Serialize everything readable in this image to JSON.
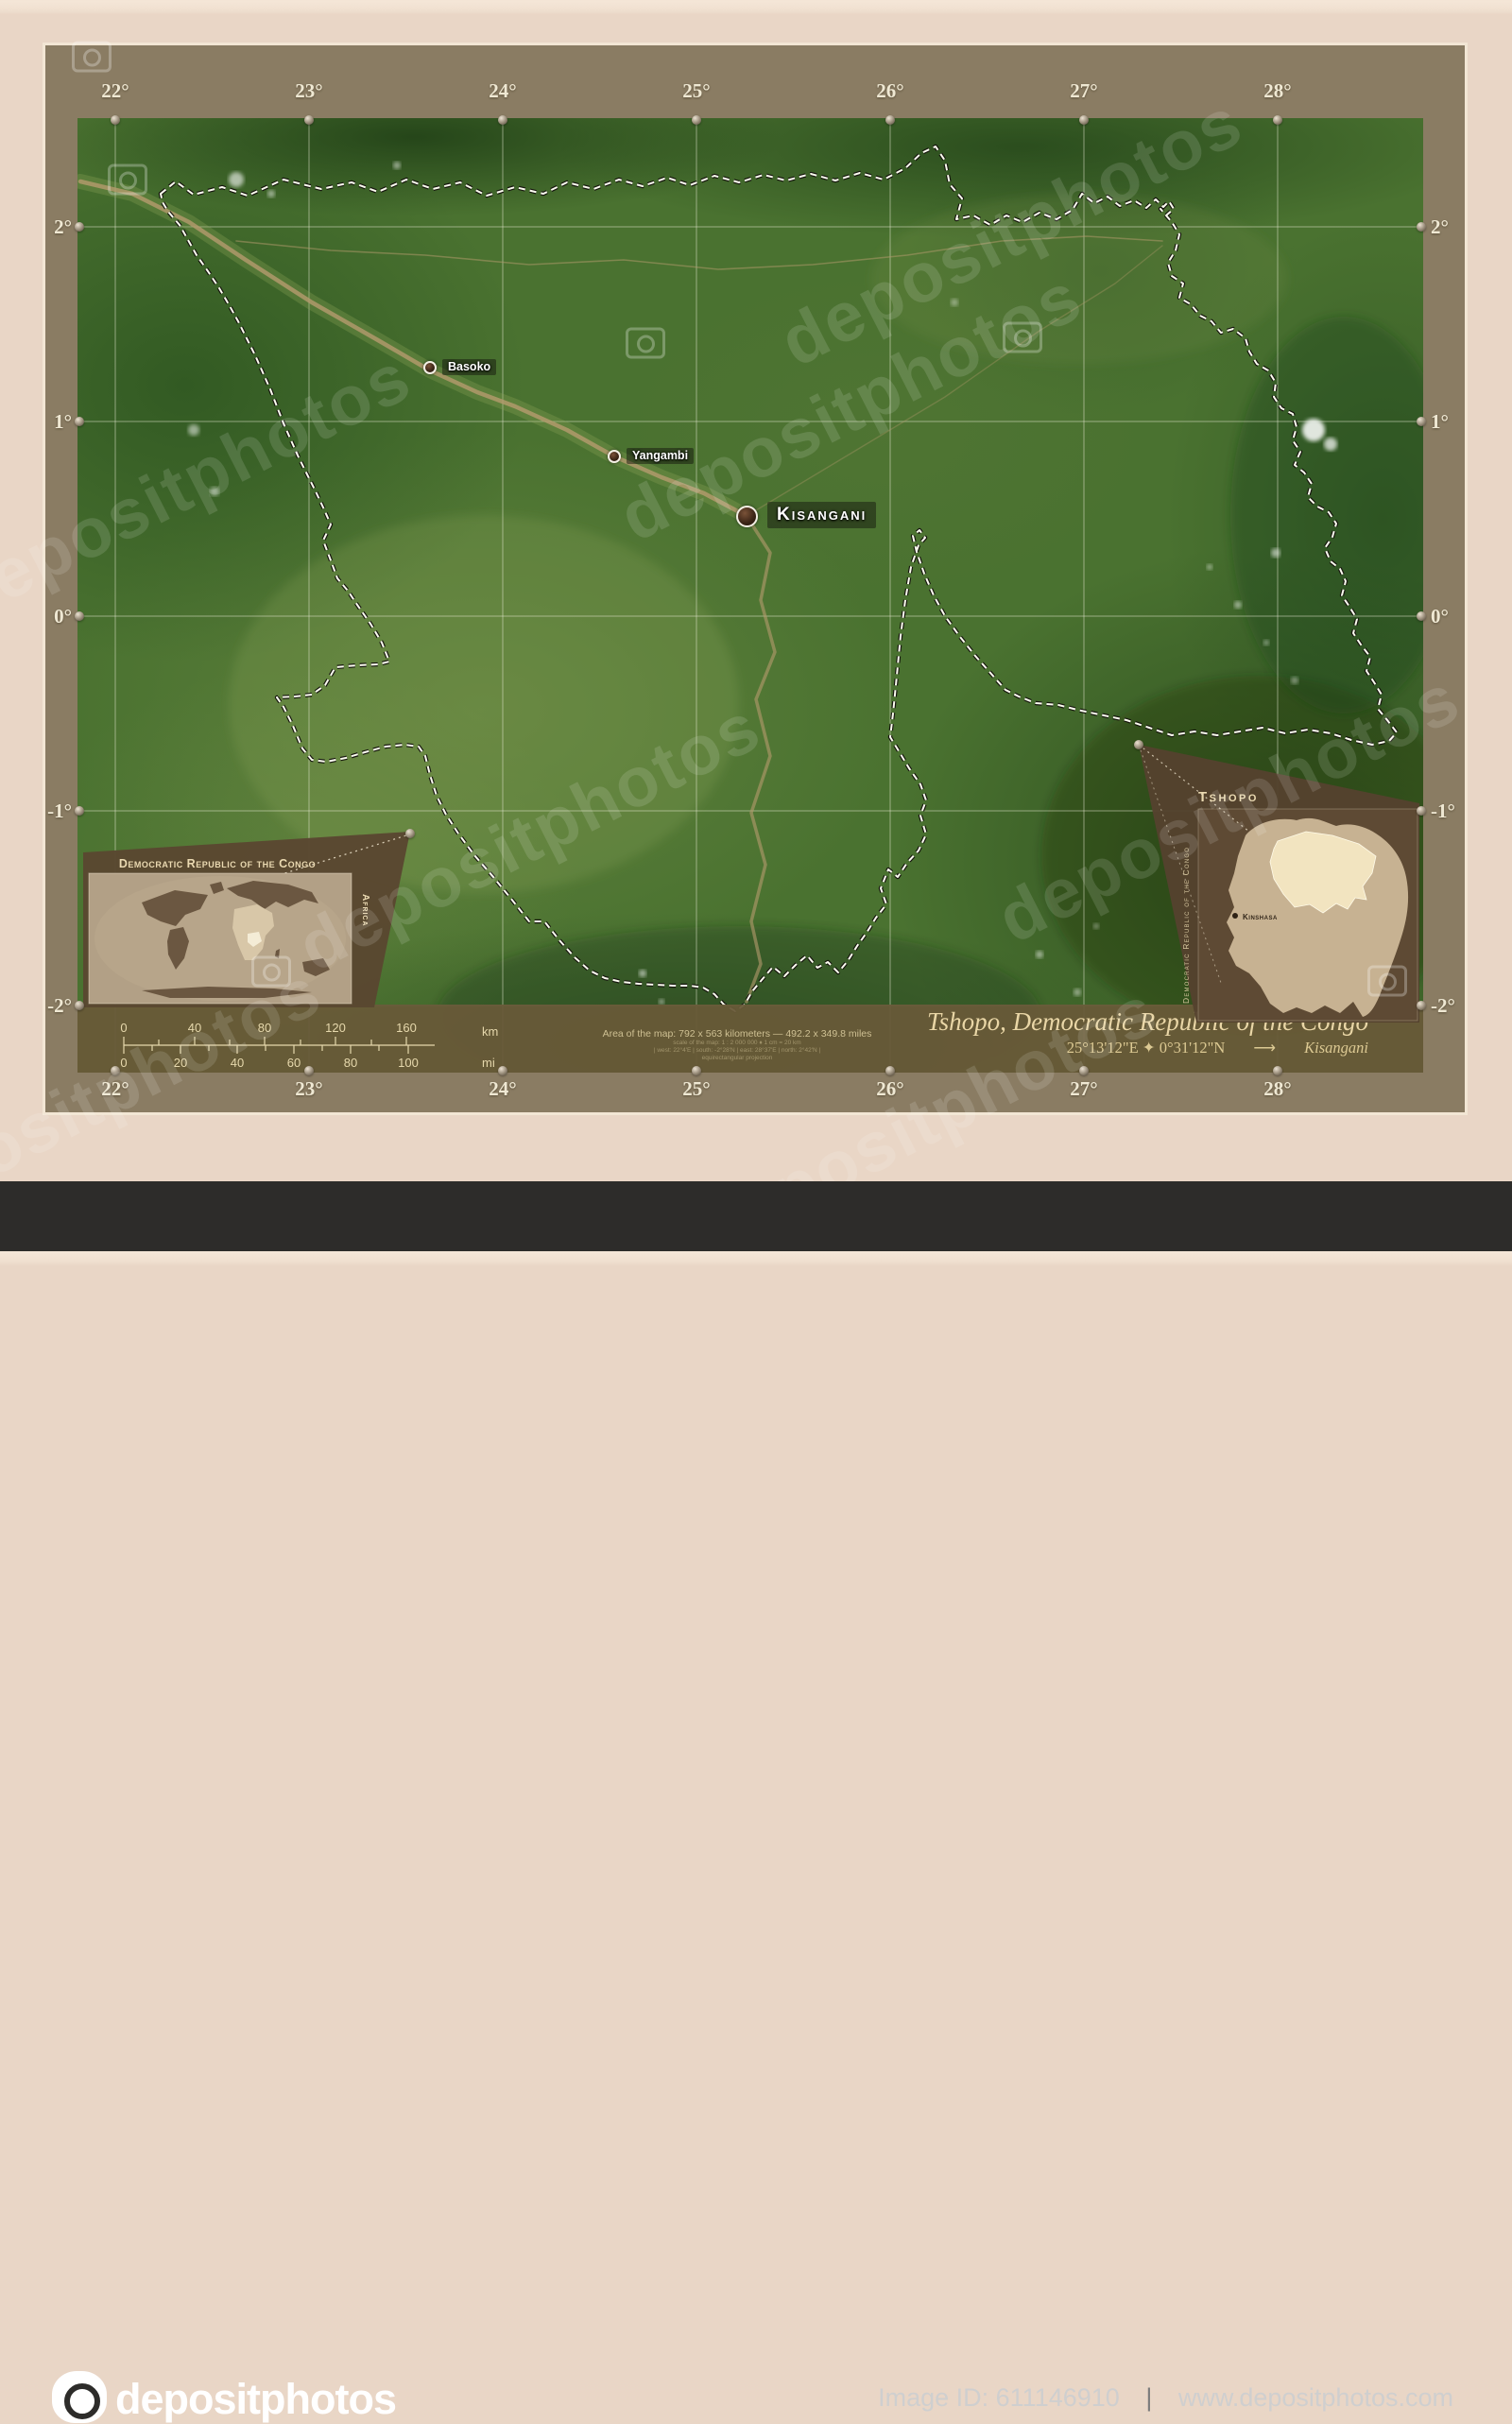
{
  "axes": {
    "lon": [
      "22°",
      "23°",
      "24°",
      "25°",
      "26°",
      "27°",
      "28°"
    ],
    "lat": [
      "2°",
      "1°",
      "0°",
      "-1°",
      "-2°"
    ]
  },
  "cities": {
    "kisangani": "Kisangani",
    "basoko": "Basoko",
    "yangambi": "Yangambi"
  },
  "insets": {
    "world": {
      "title": "Democratic Republic of the Congo",
      "region_label": "Africa"
    },
    "country": {
      "title": "Tshopo",
      "vertical_label": "Democratic Republic of the Congo",
      "capital": "Kinshasa"
    }
  },
  "scale_bar": {
    "km_ticks": [
      "0",
      "40",
      "80",
      "120",
      "160"
    ],
    "km_unit": "km",
    "mi_ticks": [
      "0",
      "20",
      "40",
      "60",
      "80",
      "100"
    ],
    "mi_unit": "mi"
  },
  "footer": {
    "area_line": "Area of the map: 792 x 563 kilometers — 492.2 x 349.8 miles",
    "credit_line1": "scale of the map: 1 : 2 000 000 ♦ 1 cm = 20 km",
    "credit_line2": "| west: 22°4'E | south: -2°28'N | east: 28°37'E | north: 2°42'N |",
    "credit_line3": "equirectangular projection",
    "title": "Tshopo, Democratic Republic of the Congo",
    "coordinates": "25°13'12\"E ✦ 0°31'12\"N",
    "arrow": "⟶",
    "capital": "Kisangani"
  },
  "watermark": {
    "text": "depositphotos"
  },
  "bottom_bar": {
    "logo_text": "depositphotos",
    "image_id": "Image ID: 611146910",
    "divider": "|",
    "website": "www.depositphotos.com"
  }
}
